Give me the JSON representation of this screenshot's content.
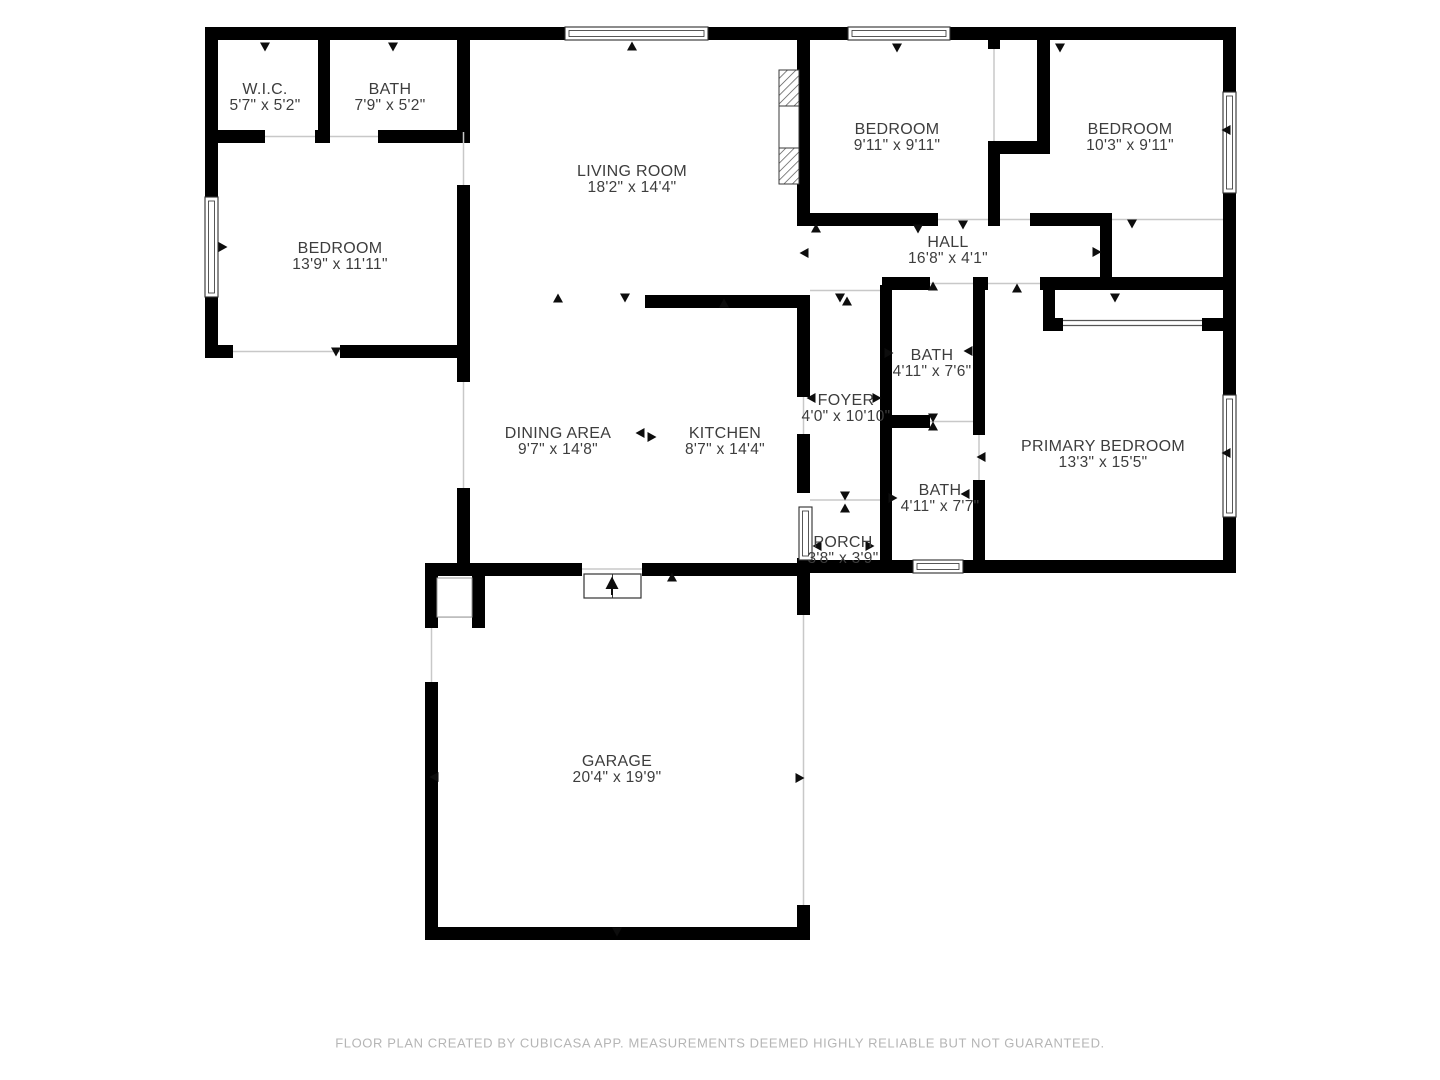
{
  "document": {
    "type": "floor-plan",
    "creator_note": "FLOOR PLAN CREATED BY CUBICASA APP. MEASUREMENTS DEEMED HIGHLY RELIABLE BUT NOT GUARANTEED."
  },
  "colors": {
    "wall": "#000000",
    "background": "#ffffff",
    "room_label_text": "#3d3d3d",
    "footer_text": "#b5b5b5",
    "opening_line": "#c8c8c8",
    "window_frame": "#2e2e2e"
  },
  "rooms": [
    {
      "id": "wic",
      "name": "W.I.C.",
      "dims": "5'7\" x 5'2\""
    },
    {
      "id": "bath-top",
      "name": "BATH",
      "dims": "7'9\" x 5'2\""
    },
    {
      "id": "living-room",
      "name": "LIVING ROOM",
      "dims": "18'2\" x 14'4\""
    },
    {
      "id": "bedroom-left",
      "name": "BEDROOM",
      "dims": "13'9\" x 11'11\""
    },
    {
      "id": "bedroom-middle",
      "name": "BEDROOM",
      "dims": "9'11\" x 9'11\""
    },
    {
      "id": "bedroom-right",
      "name": "BEDROOM",
      "dims": "10'3\" x 9'11\""
    },
    {
      "id": "hall",
      "name": "HALL",
      "dims": "16'8\" x 4'1\""
    },
    {
      "id": "bath-middle",
      "name": "BATH",
      "dims": "4'11\" x 7'6\""
    },
    {
      "id": "foyer",
      "name": "FOYER",
      "dims": "4'0\" x 10'10\""
    },
    {
      "id": "dining-area",
      "name": "DINING AREA",
      "dims": "9'7\" x 14'8\""
    },
    {
      "id": "kitchen",
      "name": "KITCHEN",
      "dims": "8'7\" x 14'4\""
    },
    {
      "id": "primary-bedroom",
      "name": "PRIMARY BEDROOM",
      "dims": "13'3\" x 15'5\""
    },
    {
      "id": "bath-lower",
      "name": "BATH",
      "dims": "4'11\" x 7'7\""
    },
    {
      "id": "porch",
      "name": "PORCH",
      "dims": "3'8\" x 3'9\""
    },
    {
      "id": "garage",
      "name": "GARAGE",
      "dims": "20'4\" x 19'9\""
    }
  ]
}
